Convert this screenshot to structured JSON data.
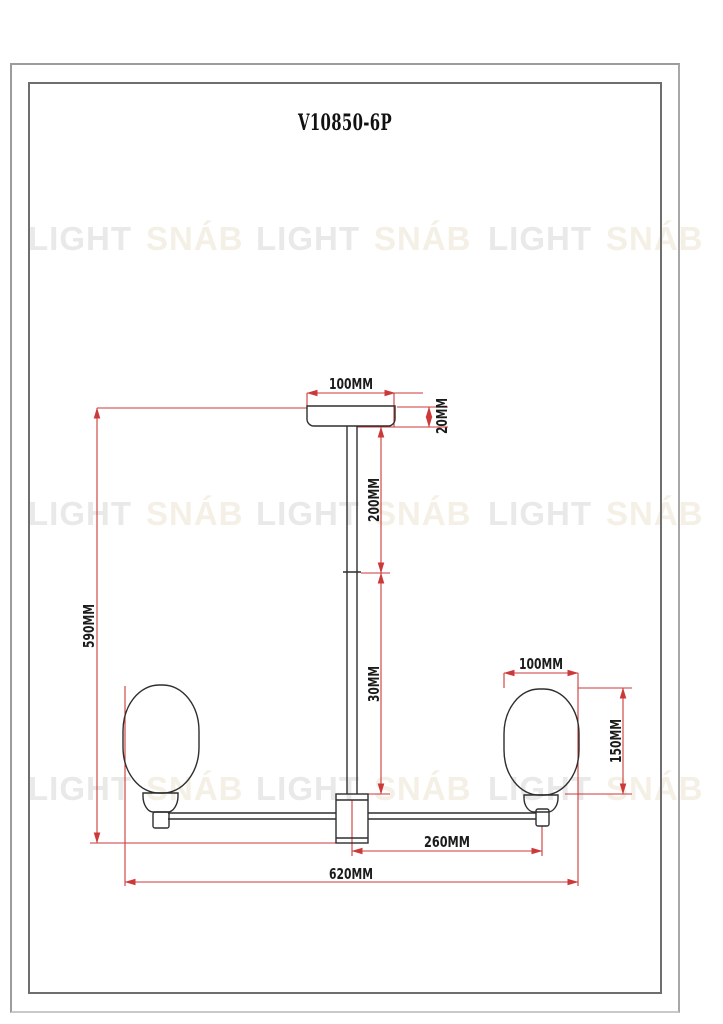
{
  "page": {
    "title": "V10850-6P"
  },
  "watermark": {
    "word1": "LIGHT",
    "word2": "SNÁB"
  },
  "dims": {
    "canopy_width": "100MM",
    "canopy_height": "20MM",
    "upper_rod_length": "200MM",
    "lower_rod_length": "30MM",
    "total_height": "590MM",
    "shade_width": "100MM",
    "shade_height": "150MM",
    "arm_length": "260MM",
    "total_width": "620MM"
  },
  "colors": {
    "dimension_red": "#cc3939",
    "outline_black": "#2e2e2e",
    "watermark_gray": "#e9e9e9",
    "watermark_cream": "#f4f0e6"
  }
}
